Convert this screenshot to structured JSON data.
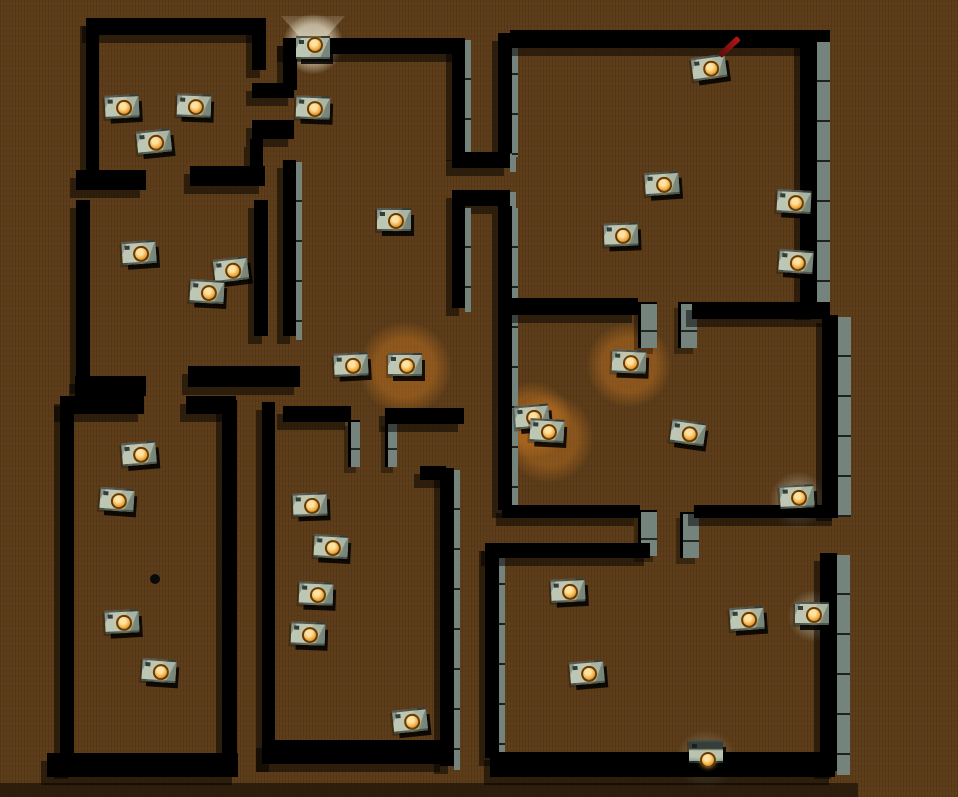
{
  "scene": {
    "description": "top-down rendered maze level with robot boxes",
    "floor_color": "#5b3b17",
    "wall_top_color": "#000000",
    "wall_face_color": "#74837c",
    "robot_body_color": "#bdc7b6",
    "robot_led_color": "#f2a93b",
    "glow_color": "rgba(210,125,35,0.4)",
    "antenna_color": "#b41818",
    "robot_count": 35
  },
  "walls": [
    {
      "x": 88,
      "y": 18,
      "w": 176,
      "h": 17
    },
    {
      "x": 86,
      "y": 18,
      "w": 13,
      "h": 160
    },
    {
      "x": 76,
      "y": 170,
      "w": 70,
      "h": 20
    },
    {
      "x": 190,
      "y": 166,
      "w": 75,
      "h": 20
    },
    {
      "x": 252,
      "y": 18,
      "w": 14,
      "h": 52
    },
    {
      "x": 252,
      "y": 83,
      "w": 42,
      "h": 15
    },
    {
      "x": 252,
      "y": 120,
      "w": 42,
      "h": 19
    },
    {
      "x": 250,
      "y": 139,
      "w": 13,
      "h": 33
    },
    {
      "x": 76,
      "y": 200,
      "w": 14,
      "h": 186
    },
    {
      "x": 254,
      "y": 200,
      "w": 14,
      "h": 136
    },
    {
      "x": 283,
      "y": 160,
      "w": 13,
      "h": 176,
      "s": "r"
    },
    {
      "x": 75,
      "y": 376,
      "w": 71,
      "h": 20
    },
    {
      "x": 188,
      "y": 366,
      "w": 112,
      "h": 21
    },
    {
      "x": 60,
      "y": 396,
      "w": 84,
      "h": 18
    },
    {
      "x": 186,
      "y": 396,
      "w": 50,
      "h": 18
    },
    {
      "x": 60,
      "y": 398,
      "w": 14,
      "h": 373
    },
    {
      "x": 222,
      "y": 400,
      "w": 15,
      "h": 368
    },
    {
      "x": 47,
      "y": 753,
      "w": 191,
      "h": 24
    },
    {
      "x": 283,
      "y": 38,
      "w": 180,
      "h": 16
    },
    {
      "x": 283,
      "y": 38,
      "w": 14,
      "h": 52
    },
    {
      "x": 452,
      "y": 38,
      "w": 13,
      "h": 115,
      "s": "r"
    },
    {
      "x": 452,
      "y": 152,
      "w": 58,
      "h": 16,
      "s": "r"
    },
    {
      "x": 452,
      "y": 190,
      "w": 58,
      "h": 16,
      "s": "r"
    },
    {
      "x": 452,
      "y": 206,
      "w": 13,
      "h": 102,
      "s": "r"
    },
    {
      "x": 283,
      "y": 406,
      "w": 68,
      "h": 16
    },
    {
      "x": 348,
      "y": 420,
      "w": 9,
      "h": 45,
      "s": "g"
    },
    {
      "x": 385,
      "y": 420,
      "w": 9,
      "h": 45,
      "s": "g"
    },
    {
      "x": 385,
      "y": 408,
      "w": 79,
      "h": 16
    },
    {
      "x": 262,
      "y": 402,
      "w": 13,
      "h": 362
    },
    {
      "x": 420,
      "y": 466,
      "w": 26,
      "h": 14
    },
    {
      "x": 440,
      "y": 468,
      "w": 14,
      "h": 298,
      "s": "r"
    },
    {
      "x": 262,
      "y": 740,
      "w": 184,
      "h": 24
    },
    {
      "x": 498,
      "y": 33,
      "w": 14,
      "h": 120,
      "s": "r"
    },
    {
      "x": 498,
      "y": 206,
      "w": 14,
      "h": 304,
      "s": "r"
    },
    {
      "x": 485,
      "y": 543,
      "w": 14,
      "h": 215,
      "s": "r"
    },
    {
      "x": 510,
      "y": 30,
      "w": 320,
      "h": 18
    },
    {
      "x": 800,
      "y": 40,
      "w": 17,
      "h": 272,
      "s": "R"
    },
    {
      "x": 508,
      "y": 298,
      "w": 130,
      "h": 17
    },
    {
      "x": 638,
      "y": 302,
      "w": 16,
      "h": 44,
      "s": "g"
    },
    {
      "x": 678,
      "y": 302,
      "w": 16,
      "h": 44,
      "s": "g"
    },
    {
      "x": 692,
      "y": 302,
      "w": 138,
      "h": 17
    },
    {
      "x": 822,
      "y": 315,
      "w": 16,
      "h": 198,
      "s": "R"
    },
    {
      "x": 502,
      "y": 505,
      "w": 138,
      "h": 13
    },
    {
      "x": 638,
      "y": 510,
      "w": 16,
      "h": 44,
      "s": "g"
    },
    {
      "x": 680,
      "y": 512,
      "w": 16,
      "h": 44,
      "s": "g"
    },
    {
      "x": 694,
      "y": 505,
      "w": 144,
      "h": 13
    },
    {
      "x": 487,
      "y": 543,
      "w": 163,
      "h": 15
    },
    {
      "x": 820,
      "y": 553,
      "w": 17,
      "h": 218,
      "s": "R"
    },
    {
      "x": 490,
      "y": 752,
      "w": 345,
      "h": 25
    }
  ],
  "glows": [
    {
      "x": 405,
      "y": 368,
      "r": 46,
      "c": "rgba(210,125,35,0.42)"
    },
    {
      "x": 629,
      "y": 365,
      "r": 42,
      "c": "rgba(210,125,35,0.40)"
    },
    {
      "x": 533,
      "y": 420,
      "r": 38,
      "c": "rgba(210,125,35,0.38)"
    },
    {
      "x": 549,
      "y": 438,
      "r": 44,
      "c": "rgba(210,125,35,0.38)"
    },
    {
      "x": 313,
      "y": 44,
      "r": 30,
      "c": "rgba(255,250,230,0.50)"
    },
    {
      "x": 798,
      "y": 500,
      "r": 28,
      "c": "rgba(190,200,190,0.28)"
    },
    {
      "x": 814,
      "y": 616,
      "r": 26,
      "c": "rgba(190,200,190,0.28)"
    },
    {
      "x": 706,
      "y": 760,
      "r": 30,
      "c": "rgba(200,210,200,0.16)"
    }
  ],
  "lamp_cone": {
    "x": 313,
    "y": 16,
    "w": 64,
    "h": 36
  },
  "floor_dot": {
    "x": 155,
    "y": 579,
    "r": 5
  },
  "shadow_bands": [
    {
      "x": 0,
      "y": 783,
      "w": 858,
      "h": 14
    }
  ],
  "robots": [
    {
      "x": 122,
      "y": 107,
      "rot": -3
    },
    {
      "x": 194,
      "y": 106,
      "rot": 2
    },
    {
      "x": 154,
      "y": 142,
      "rot": -6
    },
    {
      "x": 313,
      "y": 48,
      "rot": 0,
      "v": "lamp"
    },
    {
      "x": 313,
      "y": 108,
      "rot": 2
    },
    {
      "x": 709,
      "y": 68,
      "rot": -8,
      "v": "red"
    },
    {
      "x": 394,
      "y": 220,
      "rot": 0
    },
    {
      "x": 662,
      "y": 184,
      "rot": -4
    },
    {
      "x": 794,
      "y": 202,
      "rot": 3
    },
    {
      "x": 621,
      "y": 235,
      "rot": -2
    },
    {
      "x": 796,
      "y": 262,
      "rot": 4
    },
    {
      "x": 139,
      "y": 253,
      "rot": -4
    },
    {
      "x": 231,
      "y": 270,
      "rot": -7
    },
    {
      "x": 207,
      "y": 292,
      "rot": 3
    },
    {
      "x": 351,
      "y": 365,
      "rot": -3
    },
    {
      "x": 405,
      "y": 365,
      "rot": 0
    },
    {
      "x": 629,
      "y": 362,
      "rot": 2
    },
    {
      "x": 532,
      "y": 417,
      "rot": -5
    },
    {
      "x": 547,
      "y": 431,
      "rot": 3
    },
    {
      "x": 688,
      "y": 433,
      "rot": 8
    },
    {
      "x": 797,
      "y": 497,
      "rot": -3
    },
    {
      "x": 139,
      "y": 454,
      "rot": -5
    },
    {
      "x": 117,
      "y": 500,
      "rot": 4
    },
    {
      "x": 310,
      "y": 505,
      "rot": -2
    },
    {
      "x": 331,
      "y": 547,
      "rot": 3
    },
    {
      "x": 568,
      "y": 591,
      "rot": -3
    },
    {
      "x": 316,
      "y": 594,
      "rot": 2
    },
    {
      "x": 747,
      "y": 619,
      "rot": -4
    },
    {
      "x": 812,
      "y": 614,
      "rot": 0
    },
    {
      "x": 122,
      "y": 622,
      "rot": -3
    },
    {
      "x": 308,
      "y": 634,
      "rot": 2
    },
    {
      "x": 587,
      "y": 673,
      "rot": -5
    },
    {
      "x": 159,
      "y": 671,
      "rot": 4
    },
    {
      "x": 410,
      "y": 721,
      "rot": -6
    },
    {
      "x": 706,
      "y": 752,
      "rot": 0,
      "v": "s"
    }
  ]
}
